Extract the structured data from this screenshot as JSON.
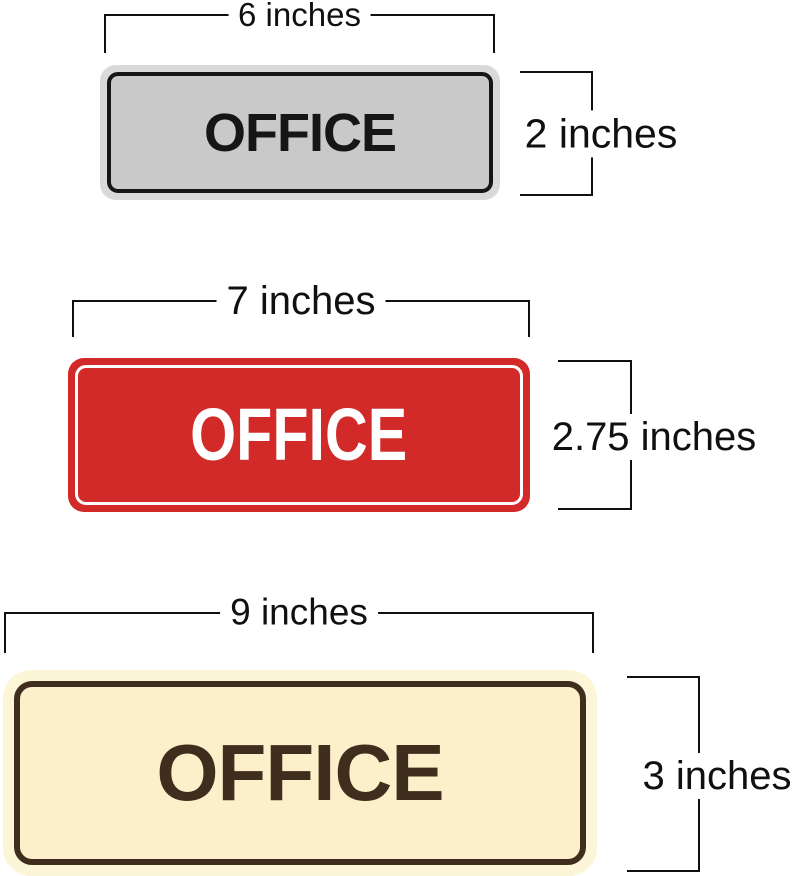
{
  "diagram_title": "office-sign-size-comparison",
  "signs": [
    {
      "label": "OFFICE",
      "style": "silver",
      "width_label": "6 inches",
      "height_label": "2 inches",
      "plate_color": "#C9C9C9",
      "ring_color": "#D9D9D9",
      "text_color": "#161616"
    },
    {
      "label": "OFFICE",
      "style": "red",
      "width_label": "7 inches",
      "height_label": "2.75 inches",
      "plate_color": "#D22929",
      "ring_color": "#FFFFFF",
      "text_color": "#FFFFFF"
    },
    {
      "label": "OFFICE",
      "style": "cream",
      "width_label": "9 inches",
      "height_label": "3 inches",
      "plate_color": "#FBF0CA",
      "ring_color": "#3F2D1E",
      "text_color": "#3F2D1E"
    }
  ],
  "colors": {
    "silver_ring": "#D9D9D9",
    "silver_plate": "#C9C9C9",
    "ink_black": "#161616",
    "red": "#D22929",
    "cream_glow": "#FCF5D8",
    "cream_plate": "#FBF0CA",
    "brown": "#3F2D1E",
    "line": "#101010"
  }
}
